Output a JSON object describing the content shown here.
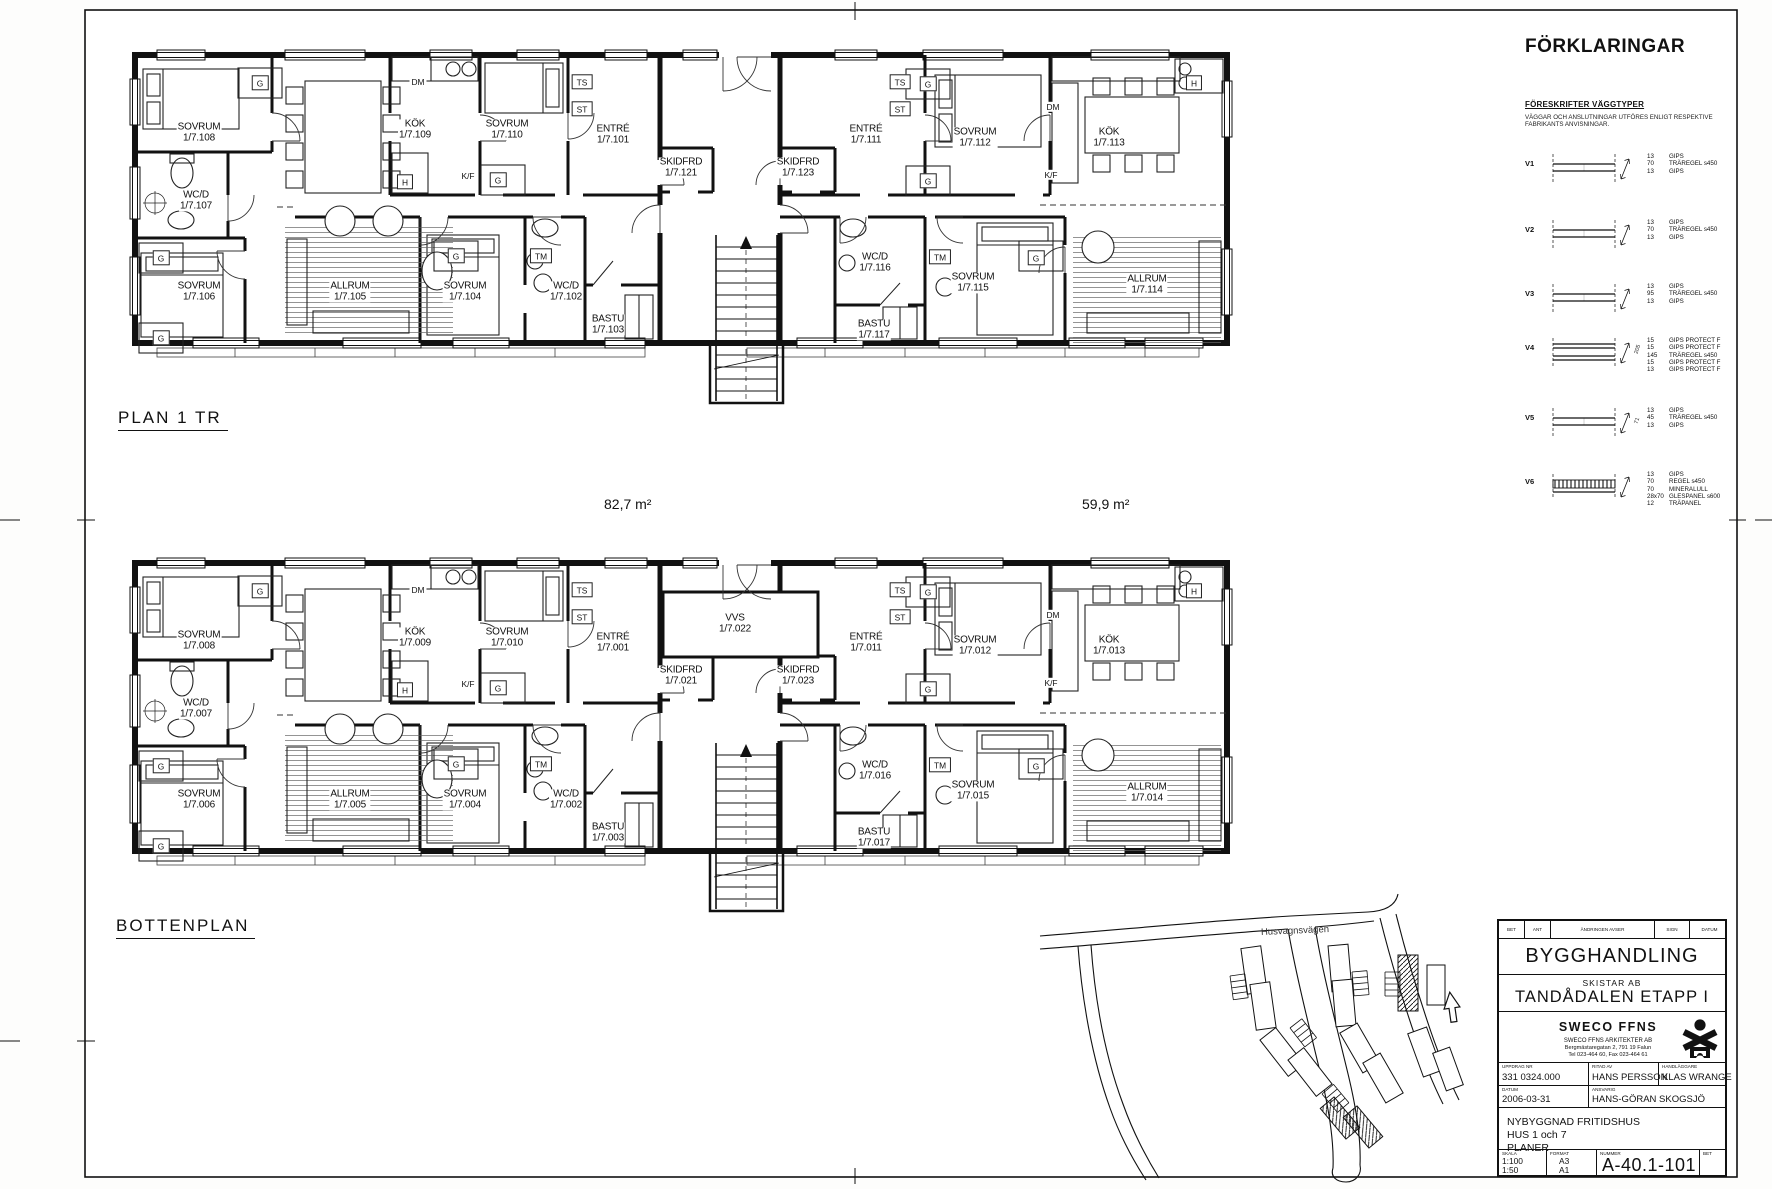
{
  "plans": [
    {
      "title": "PLAN 1 TR",
      "rooms": [
        {
          "name": "SOVRUM",
          "number": "1/7.108"
        },
        {
          "name": "WC/D",
          "number": "1/7.107"
        },
        {
          "name": "SOVRUM",
          "number": "1/7.106"
        },
        {
          "name": "KÖK",
          "number": "1/7.109"
        },
        {
          "name": "SOVRUM",
          "number": "1/7.110"
        },
        {
          "name": "ENTRÉ",
          "number": "1/7.101"
        },
        {
          "name": "SKIDFRD",
          "number": "1/7.121"
        },
        {
          "name": "SKIDFRD",
          "number": "1/7.123"
        },
        {
          "name": "ENTRÉ",
          "number": "1/7.111"
        },
        {
          "name": "SOVRUM",
          "number": "1/7.112"
        },
        {
          "name": "KÖK",
          "number": "1/7.113"
        },
        {
          "name": "ALLRUM",
          "number": "1/7.105"
        },
        {
          "name": "SOVRUM",
          "number": "1/7.104"
        },
        {
          "name": "WC/D",
          "number": "1/7.102"
        },
        {
          "name": "BASTU",
          "number": "1/7.103"
        },
        {
          "name": "WC/D",
          "number": "1/7.116"
        },
        {
          "name": "BASTU",
          "number": "1/7.117"
        },
        {
          "name": "SOVRUM",
          "number": "1/7.115"
        },
        {
          "name": "ALLRUM",
          "number": "1/7.114"
        }
      ]
    },
    {
      "title": "BOTTENPLAN",
      "rooms": [
        {
          "name": "SOVRUM",
          "number": "1/7.008"
        },
        {
          "name": "WC/D",
          "number": "1/7.007"
        },
        {
          "name": "SOVRUM",
          "number": "1/7.006"
        },
        {
          "name": "KÖK",
          "number": "1/7.009"
        },
        {
          "name": "SOVRUM",
          "number": "1/7.010"
        },
        {
          "name": "ENTRÉ",
          "number": "1/7.001"
        },
        {
          "name": "SKIDFRD",
          "number": "1/7.021"
        },
        {
          "name": "VVS",
          "number": "1/7.022"
        },
        {
          "name": "SKIDFRD",
          "number": "1/7.023"
        },
        {
          "name": "ENTRÉ",
          "number": "1/7.011"
        },
        {
          "name": "SOVRUM",
          "number": "1/7.012"
        },
        {
          "name": "KÖK",
          "number": "1/7.013"
        },
        {
          "name": "ALLRUM",
          "number": "1/7.005"
        },
        {
          "name": "SOVRUM",
          "number": "1/7.004"
        },
        {
          "name": "WC/D",
          "number": "1/7.002"
        },
        {
          "name": "BASTU",
          "number": "1/7.003"
        },
        {
          "name": "WC/D",
          "number": "1/7.016"
        },
        {
          "name": "BASTU",
          "number": "1/7.017"
        },
        {
          "name": "SOVRUM",
          "number": "1/7.015"
        },
        {
          "name": "ALLRUM",
          "number": "1/7.014"
        }
      ]
    }
  ],
  "areas": {
    "left": "82,7 m²",
    "right": "59,9 m²"
  },
  "tags": {
    "G": "G",
    "TS": "TS",
    "ST": "ST",
    "DM": "DM",
    "H": "H",
    "KF": "K/F",
    "TM": "TM"
  },
  "legend": {
    "title": "FÖRKLARINGAR",
    "section": "FÖRESKRIFTER VÄGGTYPER",
    "note1": "VÄGGAR OCH ANSLUTNINGAR UTFÖRES ENLIGT RESPEKTIVE",
    "note2": "FABRIKANTS ANVISNINGAR.",
    "wall_types": [
      {
        "id": "V1",
        "layers": [
          {
            "t": "13",
            "m": "GIPS"
          },
          {
            "t": "70",
            "m": "TRÄREGEL s450"
          },
          {
            "t": "13",
            "m": "GIPS"
          }
        ]
      },
      {
        "id": "V2",
        "layers": [
          {
            "t": "13",
            "m": "GIPS"
          },
          {
            "t": "70",
            "m": "TRÄREGEL s450"
          },
          {
            "t": "13",
            "m": "GIPS"
          }
        ]
      },
      {
        "id": "V3",
        "layers": [
          {
            "t": "13",
            "m": "GIPS"
          },
          {
            "t": "95",
            "m": "TRÄREGEL s450"
          },
          {
            "t": "13",
            "m": "GIPS"
          }
        ]
      },
      {
        "id": "V4",
        "dim": "205",
        "layers": [
          {
            "t": "15",
            "m": "GIPS PROTECT F"
          },
          {
            "t": "15",
            "m": "GIPS PROTECT F"
          },
          {
            "t": "145",
            "m": "TRÄREGEL s450"
          },
          {
            "t": "15",
            "m": "GIPS PROTECT F"
          },
          {
            "t": "13",
            "m": "GIPS PROTECT F"
          }
        ]
      },
      {
        "id": "V5",
        "dim": "71",
        "layers": [
          {
            "t": "13",
            "m": "GIPS"
          },
          {
            "t": "45",
            "m": "TRÄREGEL s450"
          },
          {
            "t": "13",
            "m": "GIPS"
          }
        ]
      },
      {
        "id": "V6",
        "hatched": true,
        "layers": [
          {
            "t": "13",
            "m": "GIPS"
          },
          {
            "t": "70",
            "m": "REGEL s450"
          },
          {
            "t": "70",
            "m": "MINERALULL"
          },
          {
            "t": "28x70",
            "m": "GLESPANEL s600"
          },
          {
            "t": "12",
            "m": "TRÄPANEL"
          }
        ]
      }
    ]
  },
  "site": {
    "road": "Husvagnsvägen"
  },
  "titleblock": {
    "rev_headers": [
      "BET",
      "ANT",
      "ÄNDRINGEN AVSER",
      "SIGN",
      "DATUM"
    ],
    "stage": "BYGGHANDLING",
    "client": "SKISTAR AB",
    "project": "TANDÅDALEN ETAPP I",
    "firm": "SWECO FFNS",
    "firm_name": "SWECO FFNS ARKITEKTER AB",
    "firm_address": "Bergmästaregatan 2, 791 19 Falun",
    "firm_phone": "Tel 023-464 60, Fax 023-464 61",
    "labels": {
      "uppdrag": "UPPDRAG NR",
      "ritad": "RITAD AV",
      "handlaggare": "HANDLÄGGARE",
      "datum": "DATUM",
      "ansvarig": "ANSVARIG",
      "skala": "SKALA",
      "format": "FORMAT",
      "nummer": "NUMMER",
      "bet": "BET"
    },
    "uppdrag_nr": "331 0324.000",
    "ritad_av": "HANS PERSSON",
    "handlaggare": "KLAS WRANGE",
    "datum": "2006-03-31",
    "ansvarig": "HANS-GÖRAN SKOGSJÖ",
    "description": [
      "NYBYGGNAD FRITIDSHUS",
      "HUS 1 och 7",
      "PLANER"
    ],
    "skala": [
      "1:100",
      "1:50"
    ],
    "format": [
      "A3",
      "A1"
    ],
    "nummer": "A-40.1-101"
  }
}
